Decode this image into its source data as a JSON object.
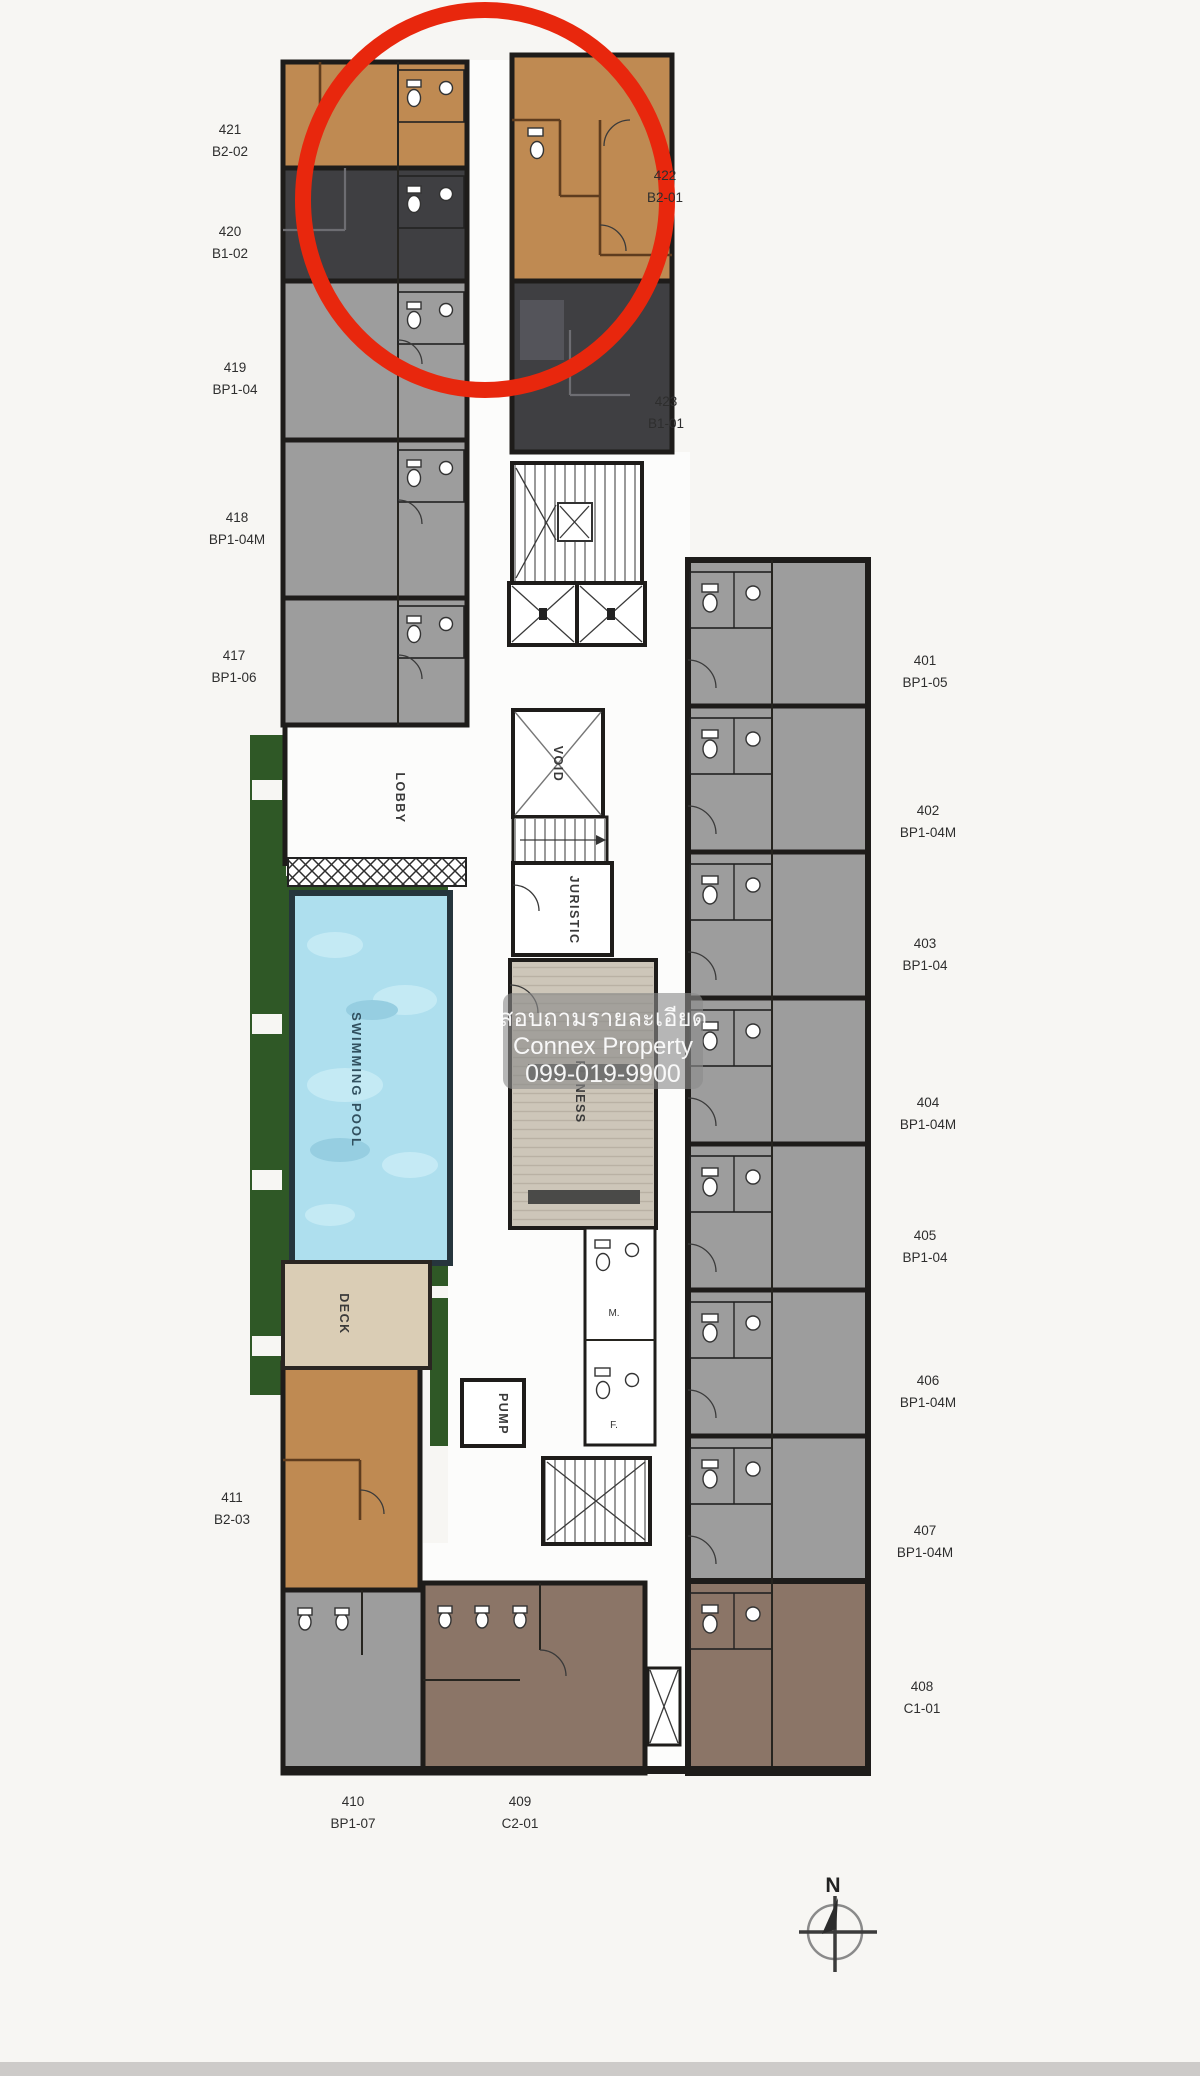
{
  "plan": {
    "watermark": {
      "line1": "สอบถามรายละเอียด",
      "line2": "Connex Property",
      "line3": "099-019-9900"
    },
    "compass_label": "N",
    "highlighted_unit": "422",
    "rooms": {
      "lobby": "LOBBY",
      "void": "VOID",
      "juristic": "JURISTIC",
      "swimming_pool": "SWIMMING POOL",
      "fitness": "FITNESS",
      "deck": "DECK",
      "pump": "PUMP",
      "male": "M.",
      "female": "F."
    },
    "units": [
      {
        "number": "421",
        "type": "B2-02"
      },
      {
        "number": "420",
        "type": "B1-02"
      },
      {
        "number": "419",
        "type": "BP1-04"
      },
      {
        "number": "418",
        "type": "BP1-04M"
      },
      {
        "number": "417",
        "type": "BP1-06"
      },
      {
        "number": "422",
        "type": "B2-01"
      },
      {
        "number": "423",
        "type": "B1-01"
      },
      {
        "number": "401",
        "type": "BP1-05"
      },
      {
        "number": "402",
        "type": "BP1-04M"
      },
      {
        "number": "403",
        "type": "BP1-04"
      },
      {
        "number": "404",
        "type": "BP1-04M"
      },
      {
        "number": "405",
        "type": "BP1-04"
      },
      {
        "number": "406",
        "type": "BP1-04M"
      },
      {
        "number": "407",
        "type": "BP1-04M"
      },
      {
        "number": "408",
        "type": "C1-01"
      },
      {
        "number": "409",
        "type": "C2-01"
      },
      {
        "number": "410",
        "type": "BP1-07"
      },
      {
        "number": "411",
        "type": "B2-03"
      }
    ],
    "colors": {
      "highlight_circle": "#e8270d",
      "unit_tan": "#bf8a52",
      "unit_dark": "#3f3f42",
      "unit_gray": "#9d9d9d",
      "unit_brown": "#8b7567",
      "pool_water": "#aedfee",
      "garden_green": "#2f5826",
      "deck_beige": "#dacdb5",
      "fitness_floor": "#cdc6b9",
      "wall": "#1e1c1a"
    }
  }
}
